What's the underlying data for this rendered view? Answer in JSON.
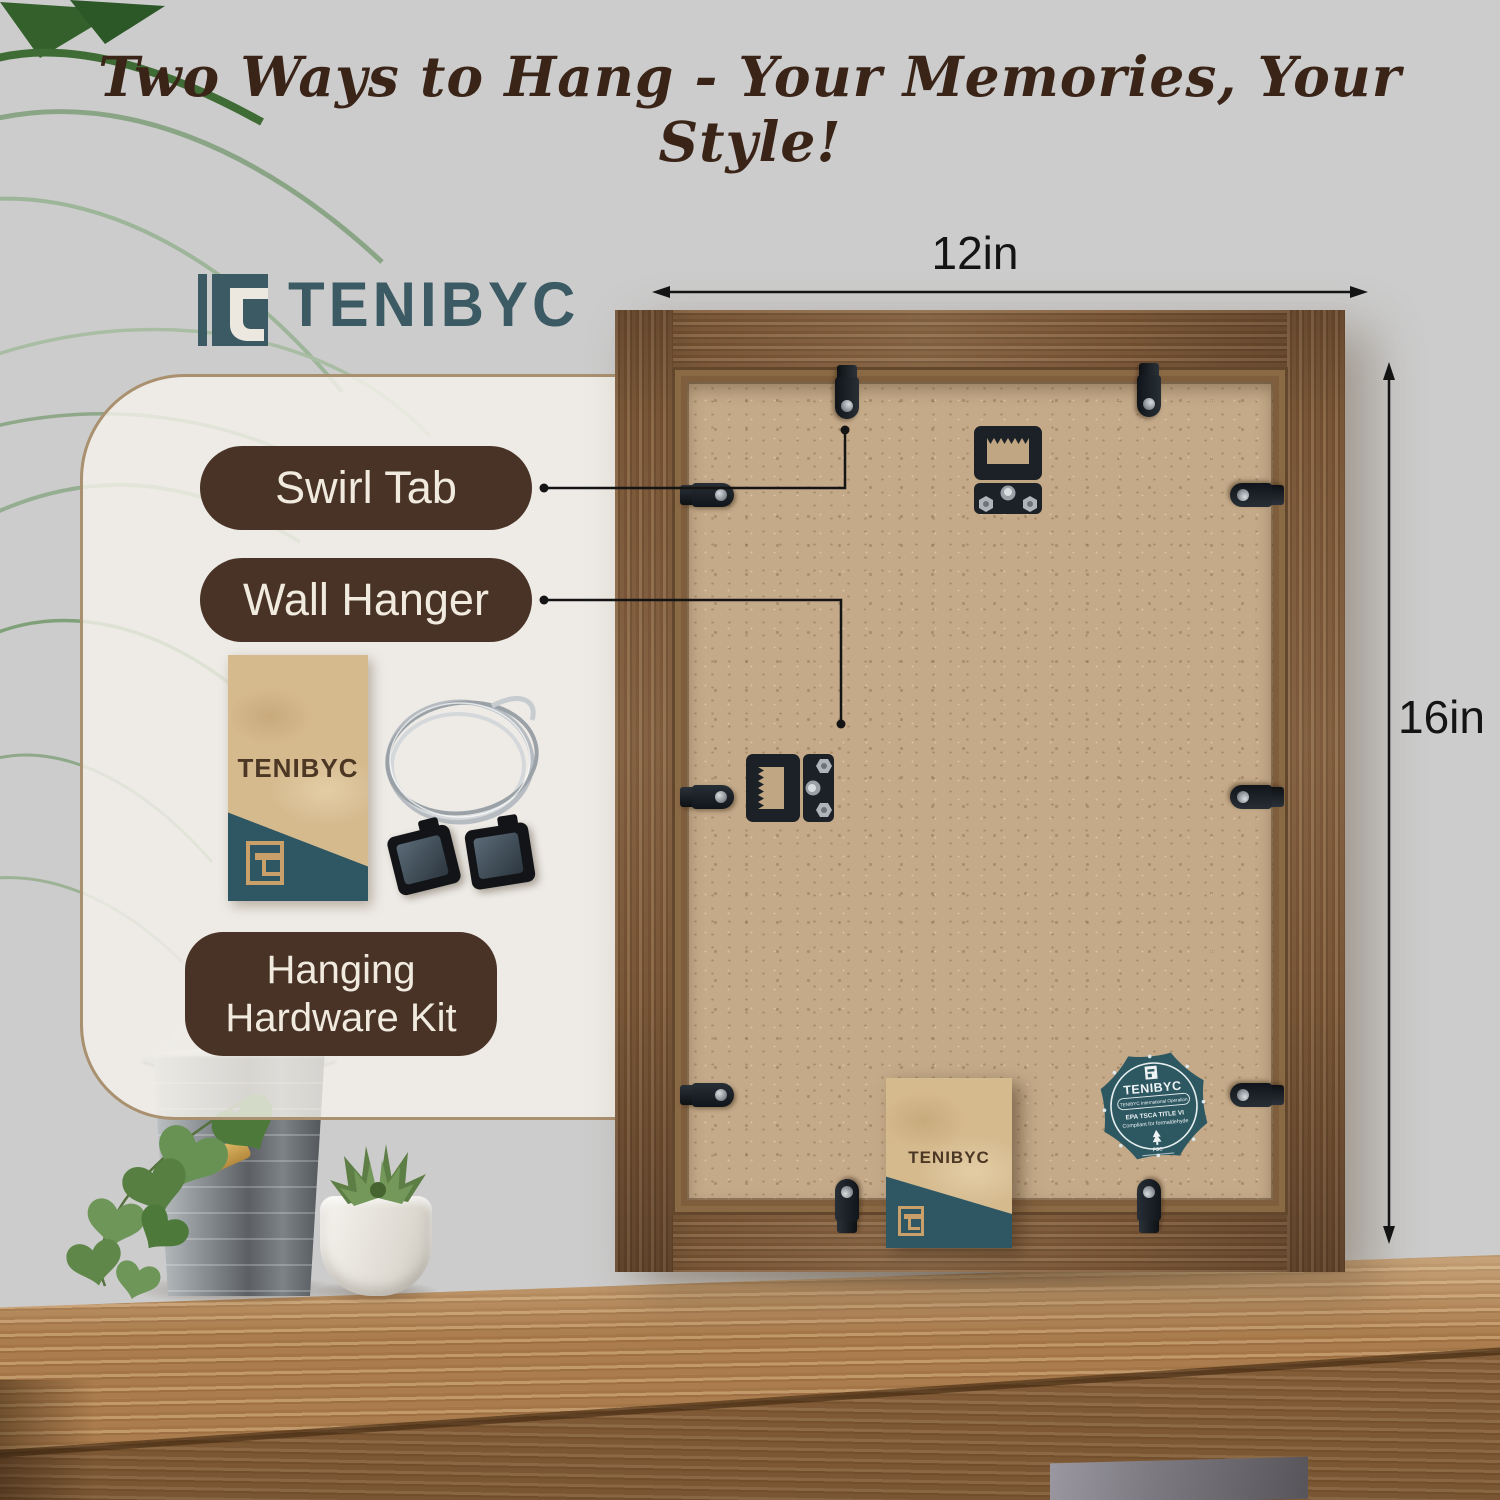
{
  "headline": "Two Ways to Hang - Your Memories, Your Style!",
  "brand": {
    "wordmark": "TENIBYC"
  },
  "card": {
    "swirl_tab_label": "Swirl Tab",
    "wall_hanger_label": "Wall Hanger",
    "kit_label_line1": "Hanging",
    "kit_label_line2": "Hardware Kit",
    "envelope_brand": "TENIBYC"
  },
  "dimensions": {
    "width": "12in",
    "height": "16in"
  },
  "frame_back": {
    "envelope_brand": "TENIBYC",
    "badge": {
      "brand": "TENIBYC",
      "banner": "TENIBYC International Operation",
      "line1": "EPA TSCA TITLE VI",
      "line2": "Compliant for formaldehyde",
      "cert": "FSC"
    }
  },
  "icons": {
    "logo_mark": "tenibyc-monogram-icon",
    "cert_mark": "fsc-tree-icon",
    "arrows": "dimension-arrow-icons"
  },
  "colors": {
    "label_brown": "#493326",
    "logo_teal": "#3c5a64",
    "badge_teal": "#2d5862",
    "frame_wood": "#7a5738",
    "mdf_tan": "#c4aa89",
    "kraft": "#d5ba8e",
    "headline_brown": "#3a2418"
  }
}
